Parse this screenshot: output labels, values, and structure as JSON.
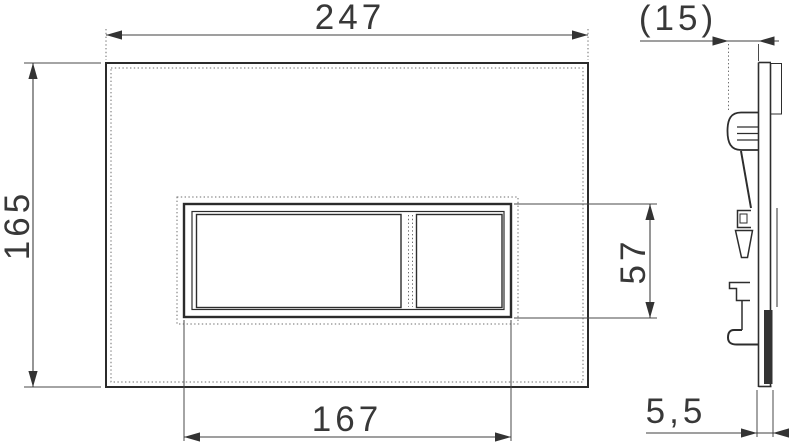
{
  "drawing": {
    "type": "technical-dimension-drawing",
    "views": {
      "front_view": {
        "description": "flush plate front elevation with two-button rocker",
        "dimensions": {
          "overall_width": "247",
          "overall_height": "165",
          "button_area_width": "167",
          "button_area_height": "57"
        }
      },
      "side_view": {
        "description": "plate side profile with mounting spring clips",
        "dimensions": {
          "overall_depth_ref": "(15)",
          "plate_thickness": "5,5"
        }
      }
    },
    "colors": {
      "line": "#2d2d2d",
      "dimension_line": "#3f3f3f",
      "hidden_line": "#6e6e6e",
      "background": "#ffffff"
    }
  }
}
